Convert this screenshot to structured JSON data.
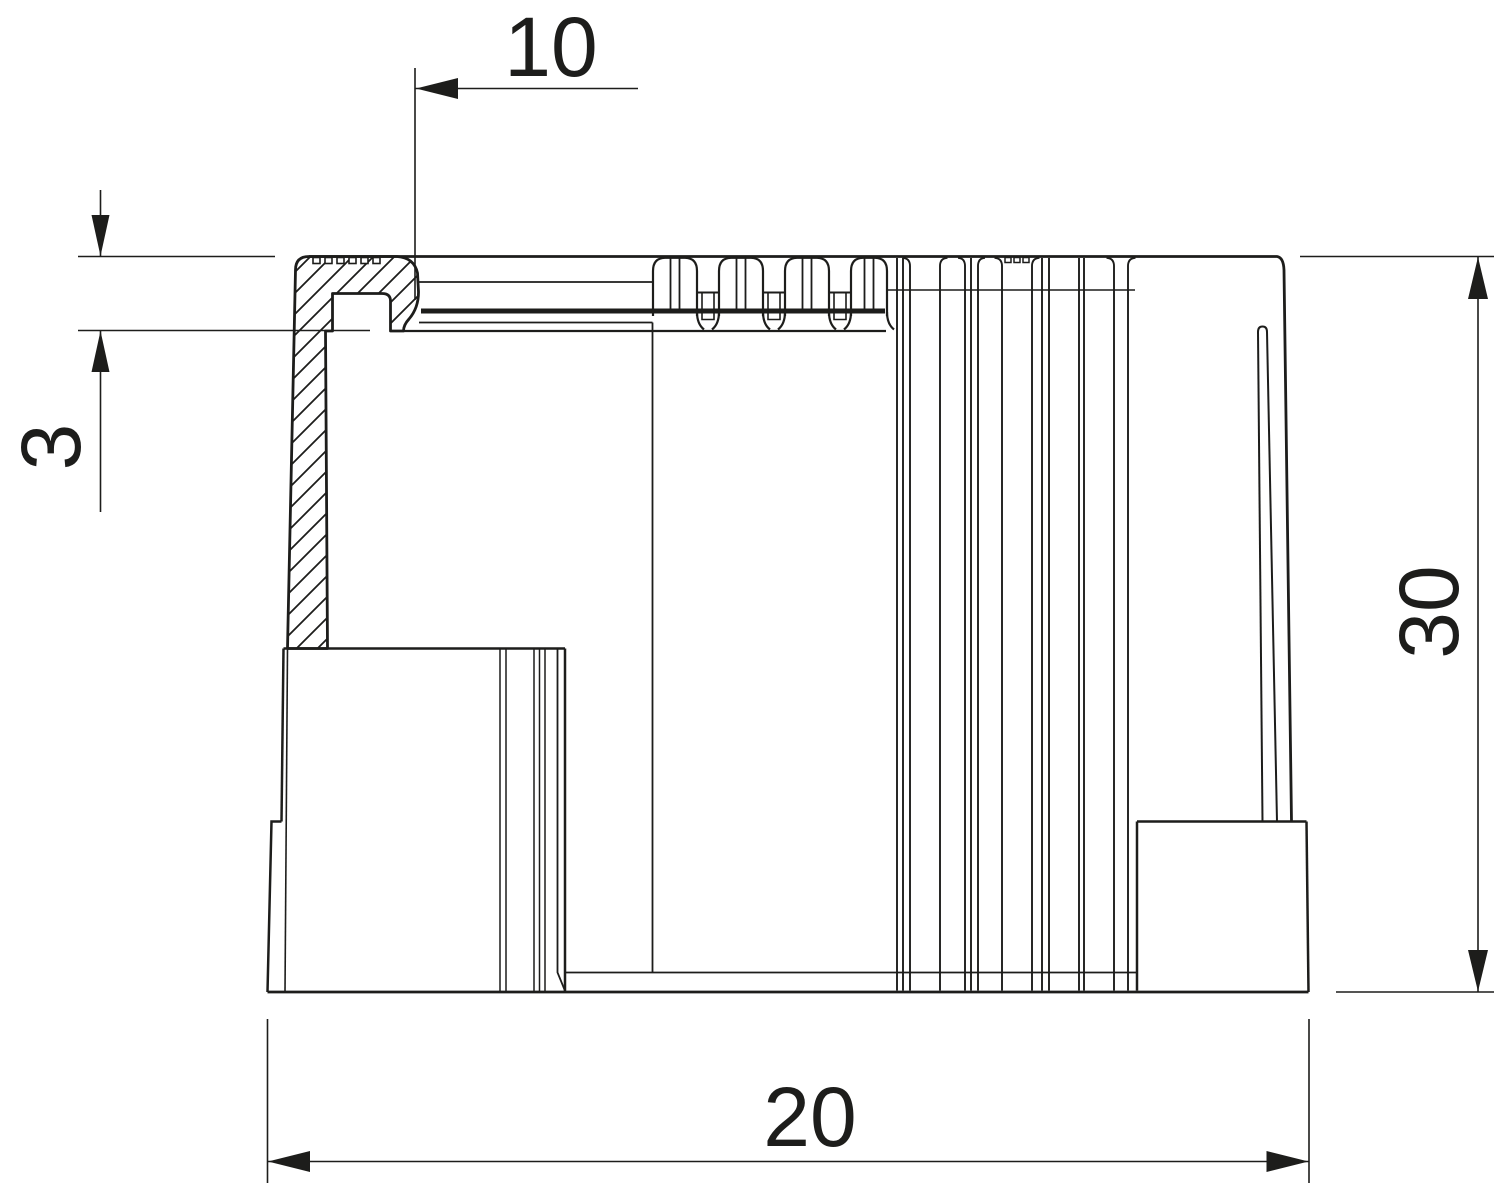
{
  "drawing": {
    "type": "technical-dimension-drawing",
    "description": "Side cross-section view of a round ribbed end cap / conduit fitting with knurled flange lip",
    "background_color": "#ffffff",
    "line_color": "#1d1d1b",
    "dimensions": {
      "flange_offset": {
        "label": "10",
        "orientation": "horizontal",
        "position": "top"
      },
      "lip_thickness": {
        "label": "3",
        "orientation": "vertical",
        "position": "left"
      },
      "overall_height": {
        "label": "30",
        "orientation": "vertical",
        "position": "right"
      },
      "overall_width": {
        "label": "20",
        "orientation": "horizontal",
        "position": "bottom"
      }
    }
  }
}
